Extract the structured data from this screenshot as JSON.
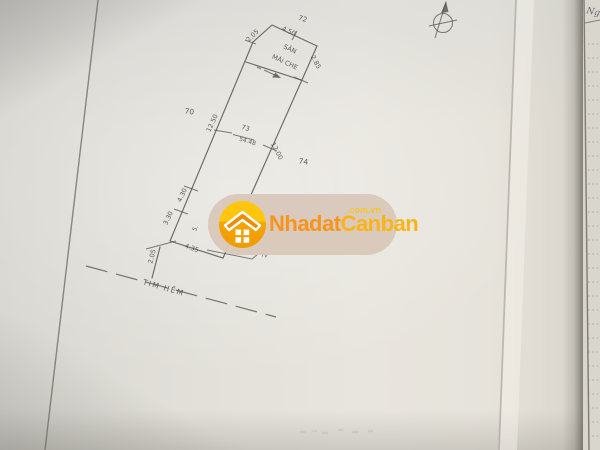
{
  "watermark": {
    "brand_primary": "Nhadat",
    "brand_secondary": "Canban",
    "domain": ".com.vn",
    "colors": {
      "pill": "#d8c8bb",
      "circle_top": "#ffc60d",
      "circle_bottom": "#f09a00",
      "house_roof": "#f08c00",
      "brand_primary_color": "#f7941d",
      "brand_secondary_color": "#fcb415"
    }
  },
  "survey_drawing": {
    "porch_label_line1": "SÂN",
    "porch_label_line2": "MÁI CHE",
    "parcel": {
      "number": "73",
      "area": "54.48"
    },
    "adjacent_parcels": {
      "top": "72",
      "left": "70",
      "right": "74"
    },
    "dimensions": {
      "top_edge": "4.50",
      "top_left_cut": "2.05",
      "right_upper": "2.85",
      "left_main": "12.50",
      "right_main": "12.00",
      "left_lower_a": "4.30",
      "left_lower_b": "3.30",
      "corner_drop": "2.05",
      "bottom_edge": "4.35"
    },
    "alley_centerline_label": "TIM HẼM",
    "point_label": "TV",
    "partial_label": "5."
  },
  "adjacent_sheet": {
    "handwriting": "Ng"
  }
}
